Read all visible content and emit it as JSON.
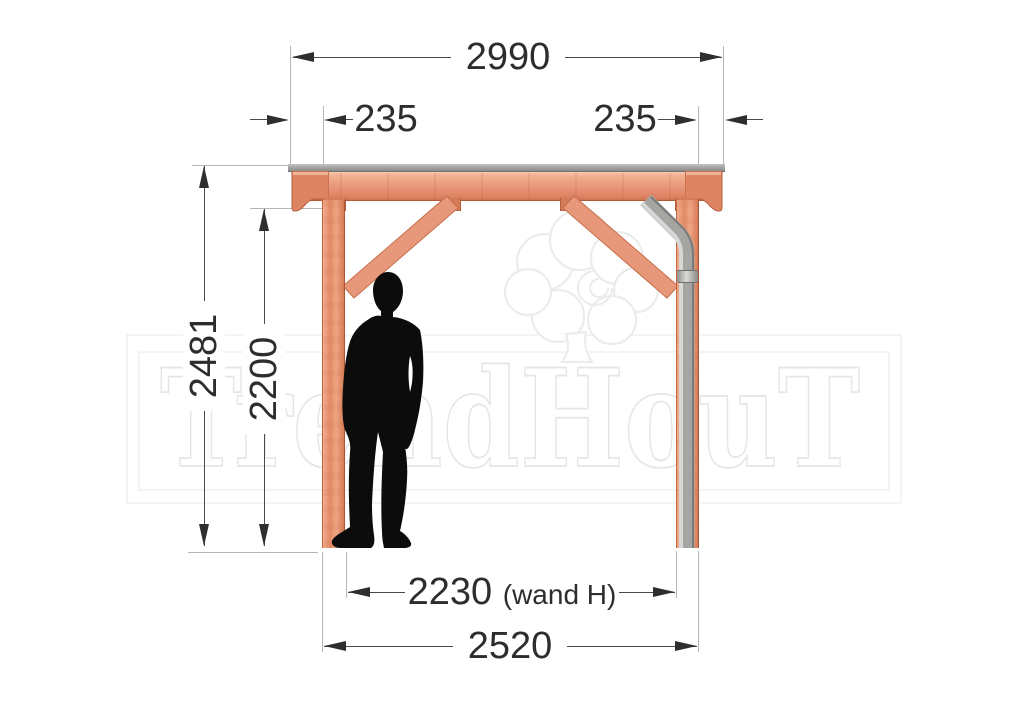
{
  "dimensions": {
    "roof_width": "2990",
    "overhang_left": "235",
    "overhang_right": "235",
    "total_height": "2481",
    "clear_height": "2200",
    "wall_width": "2230",
    "wall_width_suffix": "(wand H)",
    "post_span": "2520"
  },
  "watermark": {
    "brand": "TrendHouT"
  },
  "colors": {
    "wood_light": "#f3b79b",
    "wood_mid": "#e89372",
    "wood_dark": "#c96a45",
    "roof_gray": "#9c9c9a",
    "pipe_gray": "#a5a5a3",
    "silhouette_black": "#0c0c0c",
    "dimension_line": "#4a4a4a",
    "watermark_gray": "#ececec"
  }
}
